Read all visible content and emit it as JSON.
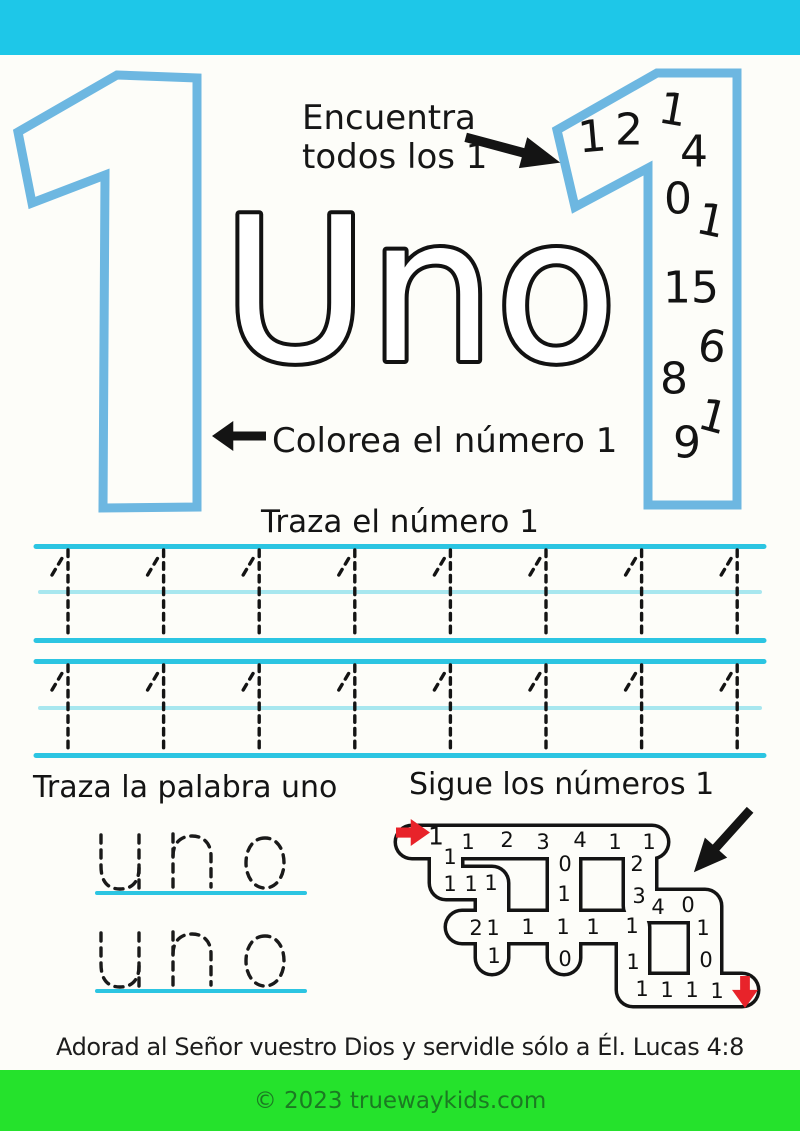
{
  "colors": {
    "top_bar": "#1ec7e8",
    "number_outline_blue": "#6db7e1",
    "trace_line_cyan": "#2cc5e2",
    "trace_line_light": "#a8e7ef",
    "green_bar": "#25e22c",
    "green_bar_text": "#1b7a22",
    "arrow_red": "#e8232a",
    "ink_black": "#141414"
  },
  "big_number": "1",
  "big_word": "Uno",
  "find": {
    "line1": "Encuentra",
    "line2": "todos los 1",
    "arrow_icon": "thick-right-down-arrow",
    "numbers": [
      {
        "c": "1",
        "x": 592,
        "y": 137,
        "r": -5
      },
      {
        "c": "2",
        "x": 629,
        "y": 130,
        "r": 0
      },
      {
        "c": "1",
        "x": 673,
        "y": 110,
        "r": 10
      },
      {
        "c": "4",
        "x": 694,
        "y": 152,
        "r": 0
      },
      {
        "c": "0",
        "x": 678,
        "y": 199,
        "r": 0
      },
      {
        "c": "1",
        "x": 711,
        "y": 221,
        "r": 12
      },
      {
        "c": "1",
        "x": 677,
        "y": 288,
        "r": 0
      },
      {
        "c": "5",
        "x": 705,
        "y": 288,
        "r": 0
      },
      {
        "c": "6",
        "x": 712,
        "y": 347,
        "r": 8
      },
      {
        "c": "8",
        "x": 674,
        "y": 379,
        "r": 0
      },
      {
        "c": "1",
        "x": 713,
        "y": 417,
        "r": 15
      },
      {
        "c": "9",
        "x": 687,
        "y": 443,
        "r": 0
      }
    ]
  },
  "colorea": {
    "label": "Colorea el número 1",
    "arrow_icon": "thick-left-arrow"
  },
  "trace_number": {
    "heading": "Traza el número 1",
    "numeral": "1",
    "rows": 2,
    "per_row": 8
  },
  "trace_word": {
    "heading": "Traza la palabra uno",
    "word": "uno",
    "rows": 2
  },
  "maze": {
    "heading": "Sigue los números 1",
    "start_arrow": "red-right-arrow",
    "end_arrow": "red-down-arrow",
    "direction_arrow": "thick-down-left-arrow",
    "numbers": [
      {
        "c": "1",
        "x": 436,
        "y": 836,
        "s": 25
      },
      {
        "c": "1",
        "x": 468,
        "y": 842
      },
      {
        "c": "2",
        "x": 507,
        "y": 840
      },
      {
        "c": "3",
        "x": 543,
        "y": 842
      },
      {
        "c": "4",
        "x": 580,
        "y": 840
      },
      {
        "c": "1",
        "x": 615,
        "y": 842
      },
      {
        "c": "1",
        "x": 649,
        "y": 842
      },
      {
        "c": "1",
        "x": 450,
        "y": 857
      },
      {
        "c": "1",
        "x": 450,
        "y": 884
      },
      {
        "c": "1",
        "x": 471,
        "y": 884
      },
      {
        "c": "1",
        "x": 491,
        "y": 883
      },
      {
        "c": "0",
        "x": 565,
        "y": 864
      },
      {
        "c": "1",
        "x": 564,
        "y": 894
      },
      {
        "c": "2",
        "x": 637,
        "y": 864
      },
      {
        "c": "3",
        "x": 639,
        "y": 896
      },
      {
        "c": "4",
        "x": 658,
        "y": 907
      },
      {
        "c": "0",
        "x": 688,
        "y": 905
      },
      {
        "c": "2",
        "x": 476,
        "y": 928
      },
      {
        "c": "1",
        "x": 493,
        "y": 928
      },
      {
        "c": "1",
        "x": 528,
        "y": 927
      },
      {
        "c": "1",
        "x": 563,
        "y": 927
      },
      {
        "c": "1",
        "x": 593,
        "y": 927
      },
      {
        "c": "1",
        "x": 632,
        "y": 926
      },
      {
        "c": "1",
        "x": 703,
        "y": 928
      },
      {
        "c": "1",
        "x": 494,
        "y": 956
      },
      {
        "c": "0",
        "x": 565,
        "y": 959
      },
      {
        "c": "0",
        "x": 706,
        "y": 960
      },
      {
        "c": "1",
        "x": 633,
        "y": 962
      },
      {
        "c": "1",
        "x": 642,
        "y": 989
      },
      {
        "c": "1",
        "x": 667,
        "y": 990
      },
      {
        "c": "1",
        "x": 692,
        "y": 990
      },
      {
        "c": "1",
        "x": 717,
        "y": 991
      }
    ]
  },
  "verse": "Adorad al Señor vuestro Dios y servidle sólo a Él. Lucas 4:8",
  "footer": {
    "text": "© 2023 truewaykids.com"
  }
}
